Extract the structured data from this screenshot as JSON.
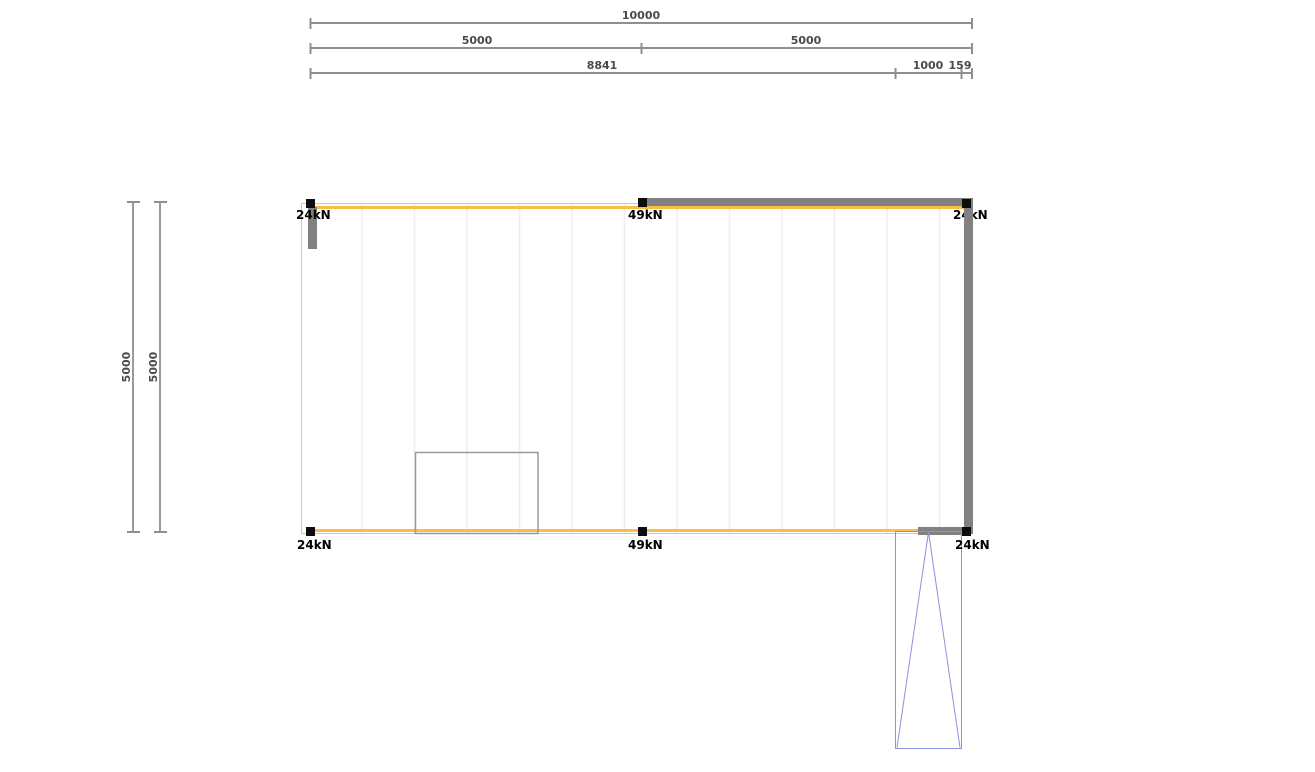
{
  "drawing": {
    "type": "structural-floor-plan",
    "units": "mm"
  },
  "dims": {
    "total": "10000",
    "half_left": "5000",
    "half_right": "5000",
    "seg_main": "8841",
    "seg_opening": "1000",
    "seg_edge": "159",
    "side_outer": "5000",
    "side_inner": "5000"
  },
  "loads": {
    "top_left": "24kN",
    "top_mid": "49kN",
    "top_right": "24kN",
    "bottom_left": "24kN",
    "bottom_mid": "49kN",
    "bottom_right": "24kN"
  },
  "colors": {
    "dimension_line": "#8f8f8f",
    "dimension_text": "#4a4a4a",
    "load_text": "#000000",
    "beam_orange": "#fdbc47",
    "wall_gray": "#818181",
    "outline_gray": "#c8c8c8",
    "gridline_gray": "#eeeeee",
    "marker_black": "#0d0d0d",
    "door_blue": "#8d90e0",
    "inner_rect_gray": "#9a9a9a",
    "background": "#ffffff"
  }
}
